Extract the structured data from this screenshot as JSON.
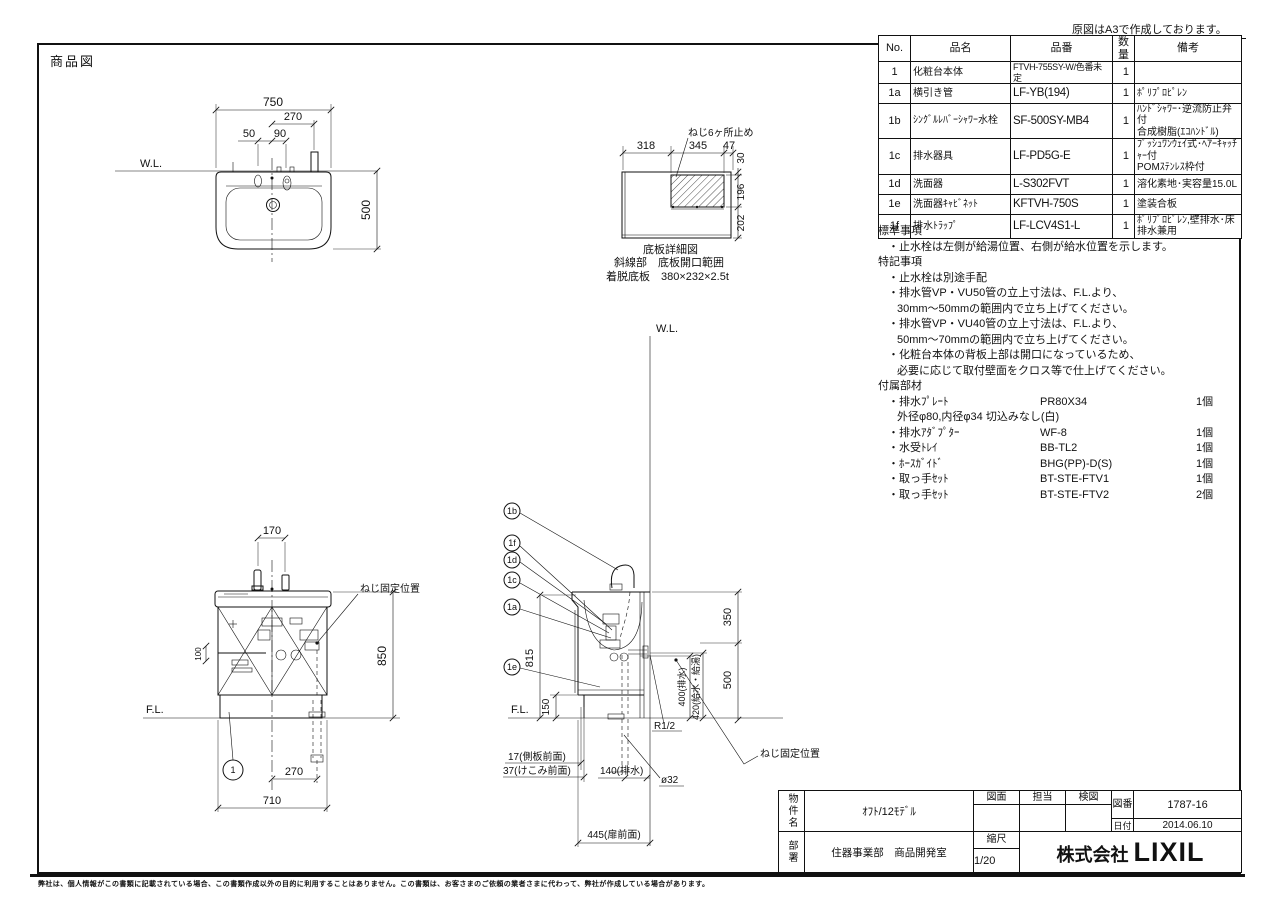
{
  "page": {
    "corner_note": "原図はA3で作成しております。",
    "title_label": "商品図",
    "disclaimer": "弊社は、個人情報がこの書類に記載されている場合、この書類作成以外の目的に利用することはありません。この書類は、お客さまのご依頼の業者さまに代わって、弊社が作成している場合があります。"
  },
  "parts_table": {
    "headers": {
      "no": "No.",
      "name": "品名",
      "code": "品番",
      "qty": "数量",
      "remark": "備考"
    },
    "rows": [
      {
        "no": "1",
        "name": "化粧台本体",
        "code": "FTVH-755SY-W/色番未定",
        "qty": "1",
        "remark": ""
      },
      {
        "no": "1a",
        "name": "横引き管",
        "code": "LF-YB(194)",
        "qty": "1",
        "remark": "ﾎﾟﾘﾌﾟﾛﾋﾟﾚﾝ"
      },
      {
        "no": "1b",
        "name": "ｼﾝｸﾞﾙﾚﾊﾞｰｼｬﾜｰ水栓",
        "code": "SF-500SY-MB4",
        "qty": "1",
        "remark": "ﾊﾝﾄﾞｼｬﾜｰ･逆流防止弁付\n合成樹脂(ｴｺﾊﾝﾄﾞﾙ)"
      },
      {
        "no": "1c",
        "name": "排水器具",
        "code": "LF-PD5G-E",
        "qty": "1",
        "remark": "ﾌﾟｯｼｭﾜﾝｳｪｲ式･ﾍｱｰｷｬｯﾁｬｰ付\nPOMｽﾃﾝﾚｽ枠付"
      },
      {
        "no": "1d",
        "name": "洗面器",
        "code": "L-S302FVT",
        "qty": "1",
        "remark": "溶化素地･実容量15.0L"
      },
      {
        "no": "1e",
        "name": "洗面器ｷｬﾋﾞﾈｯﾄ",
        "code": "KFTVH-750S",
        "qty": "1",
        "remark": "塗装合板"
      },
      {
        "no": "1f",
        "name": "排水ﾄﾗｯﾌﾟ",
        "code": "LF-LCV4S1-L",
        "qty": "1",
        "remark": "ﾎﾟﾘﾌﾟﾛﾋﾟﾚﾝ,壁排水･床排水兼用"
      }
    ]
  },
  "notes": {
    "lines": [
      "標準事項",
      "・止水栓は左側が給湯位置、右側が給水位置を示します。",
      "特記事項",
      "・止水栓は別途手配",
      "・排水管VP・VU50管の立上寸法は、F.L.より、",
      "30mm～50mmの範囲内で立ち上げてください。",
      "・排水管VP・VU40管の立上寸法は、F.L.より、",
      "50mm～70mmの範囲内で立ち上げてください。",
      "・化粧台本体の背板上部は開口になっているため、",
      "必要に応じて取付壁面をクロス等で仕上げてください。",
      "付属部材"
    ]
  },
  "accessories": {
    "rows": [
      {
        "name": "・排水ﾌﾟﾚｰﾄ",
        "code": "PR80X34",
        "qty": "1個"
      },
      {
        "name": "・排水ｱﾀﾞﾌﾟﾀｰ",
        "code": "WF-8",
        "qty": "1個"
      },
      {
        "name": "・水受ﾄﾚｲ",
        "code": "BB-TL2",
        "qty": "1個"
      },
      {
        "name": "・ﾎｰｽｶﾞｲﾄﾞ",
        "code": "BHG(PP)-D(S)",
        "qty": "1個"
      },
      {
        "name": "・取っ手ｾｯﾄ",
        "code": "BT-STE-FTV1",
        "qty": "1個"
      },
      {
        "name": "・取っ手ｾｯﾄ",
        "code": "BT-STE-FTV2",
        "qty": "2個"
      }
    ],
    "row0_note": "外径φ80,内径φ34 切込みなし(白)"
  },
  "title_block": {
    "bukken_label": "物件名",
    "bukken_value": "ｵﾌﾄ/12ﾓﾃﾞﾙ",
    "zumen": "図面",
    "tanto": "担当",
    "kenzu": "検図",
    "zuban_label": "図番",
    "zuban_value": "1787-16",
    "date_label": "日付",
    "date_value": "2014.06.10",
    "busho_label": "部署",
    "busho_value": "住器事業部　商品開発室",
    "scale_label": "縮尺",
    "scale_value": "1/20",
    "company_prefix": "株式会社",
    "company_name": "LIXIL"
  },
  "drawing": {
    "plan": {
      "wl": "W.L.",
      "d750": "750",
      "d270": "270",
      "d50": "50",
      "d90": "90",
      "d500": "500"
    },
    "detail": {
      "screw_note": "ねじ6ヶ所止め",
      "d318": "318",
      "d345": "345",
      "d47": "47",
      "d30": "30",
      "d196": "196",
      "d202": "202",
      "caption": "底板詳細図",
      "hatch_note": "斜線部　底板開口範囲",
      "plate_note": "着脱底板　380×232×2.5t"
    },
    "front": {
      "d170": "170",
      "screw_label": "ねじ固定位置",
      "d850": "850",
      "d100": "100",
      "fl": "F.L.",
      "balloon1": "1",
      "d270": "270",
      "d710": "710"
    },
    "side": {
      "wl": "W.L.",
      "b1b": "1b",
      "b1f": "1f",
      "b1d": "1d",
      "b1c": "1c",
      "b1a": "1a",
      "b1e": "1e",
      "d815": "815",
      "d150": "150",
      "fl": "F.L.",
      "d350": "350",
      "d500": "500",
      "d400": "400(排水)",
      "d420": "420(給水・給湯)",
      "r12": "R1/2",
      "d17": "17(側板前面)",
      "d37": "37(けこみ前面)",
      "d140": "140(排水)",
      "dia32": "ø32",
      "d445": "445(扉前面)",
      "screw_label": "ねじ固定位置"
    }
  }
}
